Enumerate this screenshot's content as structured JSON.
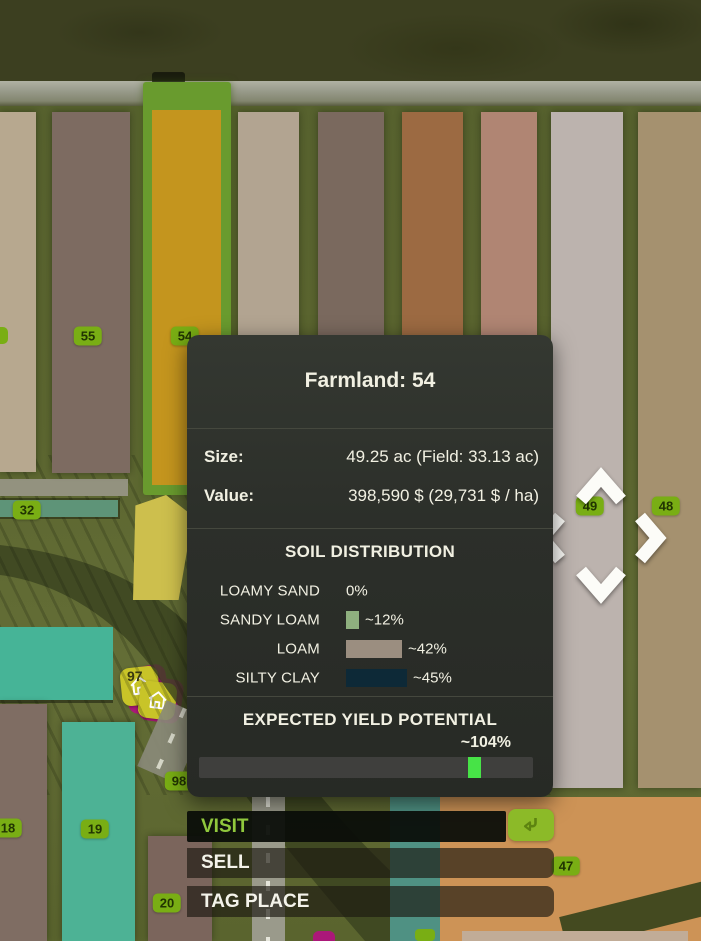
{
  "panel": {
    "title": "Farmland: 54",
    "size_label": "Size:",
    "size_value": "49.25 ac (Field: 33.13 ac)",
    "value_label": "Value:",
    "value_value": "398,590 $ (29,731 $ / ha)",
    "soil": {
      "title": "SOIL DISTRIBUTION",
      "rows": [
        {
          "label": "LOAMY SAND",
          "percent": "0%",
          "swatch_color": null,
          "swatch_width": 0
        },
        {
          "label": "SANDY LOAM",
          "percent": "~12%",
          "swatch_color": "#8fb07f",
          "swatch_width": 13
        },
        {
          "label": "LOAM",
          "percent": "~42%",
          "swatch_color": "#9b8e80",
          "swatch_width": 56
        },
        {
          "label": "SILTY CLAY",
          "percent": "~45%",
          "swatch_color": "#0d2937",
          "swatch_width": 61
        }
      ]
    },
    "yield": {
      "title": "EXPECTED YIELD POTENTIAL",
      "value": "~104%",
      "bar_fraction": 0.805,
      "indicator_color": "#47e347"
    }
  },
  "actions": {
    "visit_label": "VISIT",
    "sell_label": "SELL",
    "tag_label": "TAG PLACE"
  },
  "map": {
    "badges": [
      {
        "label": "55",
        "x": 88,
        "y": 336
      },
      {
        "label": "54",
        "x": 185,
        "y": 336
      },
      {
        "label": "32",
        "x": 27,
        "y": 510
      },
      {
        "label": "49",
        "x": 590,
        "y": 506
      },
      {
        "label": "48",
        "x": 666,
        "y": 506
      },
      {
        "label": "98",
        "x": 179,
        "y": 781
      },
      {
        "label": "18",
        "x": 8,
        "y": 828
      },
      {
        "label": "19",
        "x": 95,
        "y": 829
      },
      {
        "label": "20",
        "x": 167,
        "y": 903
      },
      {
        "label": "47",
        "x": 566,
        "y": 866
      }
    ],
    "tag_marker_label": "97"
  },
  "colors": {
    "accent_green": "#90c83d",
    "badge_green": "#79ae14",
    "enter_green": "#8cba28",
    "marker_magenta": "#ab1879",
    "marker_yellow": "#c8c428",
    "selection_highlight": "#699b2e"
  }
}
